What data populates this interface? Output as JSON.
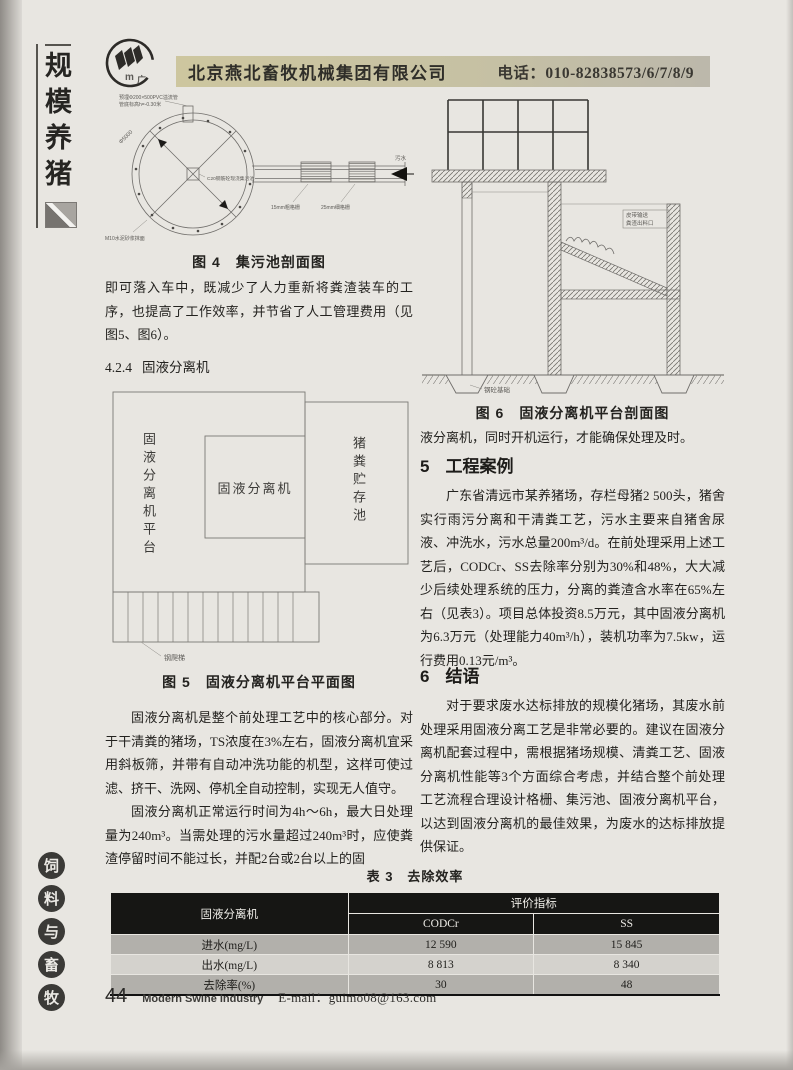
{
  "sidebar": {
    "top_chars": [
      "规",
      "模",
      "养",
      "猪"
    ],
    "badge_chars": [
      "饲",
      "料",
      "与",
      "畜",
      "牧"
    ]
  },
  "header": {
    "company": "北京燕北畜牧机械集团有限公司",
    "phone": "电话：010-82838573/6/7/8/9",
    "banner_color": "#cdc69f"
  },
  "left_column": {
    "figure4": {
      "caption": "图 4　集污池剖面图",
      "labels": {
        "pipe_note_1": "预埋Φ200×500PVC溢流管",
        "pipe_note_2": "管底标高h=-0.30米",
        "diameter": "Φ5000",
        "center_note": "C20钢筋砼现浇集污池",
        "grate_coarse": "15mm粗格栅",
        "grate_fine": "25mm细格栅",
        "wall_note": "M10水泥砂浆抹面",
        "inlet": "污水"
      }
    },
    "para_top": "即可落入车中，既减少了人力重新将粪渣装车的工序，也提高了工作效率，并节省了人工管理费用（见图5、图6）。",
    "heading_424": {
      "num": "4.2.4",
      "title": "固液分离机"
    },
    "figure5": {
      "caption": "图 5　固液分离机平台平面图",
      "labels": {
        "platform": "固液分离机平台",
        "machine": "固液分离机",
        "storage": "猪粪贮存池",
        "ladder": "钢爬梯"
      }
    },
    "para_core": "固液分离机是整个前处理工艺中的核心部分。对于干清粪的猪场，TS浓度在3%左右，固液分离机宜采用斜板筛，并带有自动冲洗功能的机型，这样可使过滤、挤干、洗网、停机全自动控制，实现无人值守。",
    "para_runtime": "固液分离机正常运行时间为4h～6h，最大日处理量为240m³。当需处理的污水量超过240m³时，应使粪渣停留时间不能过长，并配2台或2台以上的固"
  },
  "right_column": {
    "figure6": {
      "caption": "图 6　固液分离机平台剖面图",
      "labels": {
        "note_line_1": "皮带输送",
        "note_line_2": "粪渣出料口",
        "foundation": "钢砼基础"
      }
    },
    "para_continuation": "液分离机，同时开机运行，才能确保处理及时。",
    "section5": {
      "num": "5",
      "title": "工程案例",
      "body": "广东省清远市某养猪场，存栏母猪2 500头，猪舍实行雨污分离和干清粪工艺，污水主要来自猪舍尿液、冲洗水，污水总量200m³/d。在前处理采用上述工艺后，CODCr、SS去除率分别为30%和48%，大大减少后续处理系统的压力，分离的粪渣含水率在65%左右（见表3）。项目总体投资8.5万元，其中固液分离机为6.3万元（处理能力40m³/h），装机功率为7.5kw，运行费用0.13元/m³。"
    },
    "section6": {
      "num": "6",
      "title": "结语",
      "body": "对于要求废水达标排放的规模化猪场，其废水前处理采用固液分离工艺是非常必要的。建议在固液分离机配套过程中，需根据猪场规模、清粪工艺、固液分离机性能等3个方面综合考虑，并结合整个前处理工艺流程合理设计格栅、集污池、固液分离机平台，以达到固液分离机的最佳效果，为废水的达标排放提供保证。"
    }
  },
  "table3": {
    "title": "表 3　去除效率",
    "corner": "固液分离机",
    "group_header": "评价指标",
    "columns": [
      "CODCr",
      "SS"
    ],
    "rows": [
      {
        "label": "进水(mg/L)",
        "codcr": "12 590",
        "ss": "15 845"
      },
      {
        "label": "出水(mg/L)",
        "codcr": "8 813",
        "ss": "8 340"
      },
      {
        "label": "去除率(%)",
        "codcr": "30",
        "ss": "48"
      }
    ]
  },
  "footer": {
    "page_number": "44",
    "journal": "Modern Swine Industry",
    "email": "E-mail：guimo08@163.com"
  }
}
